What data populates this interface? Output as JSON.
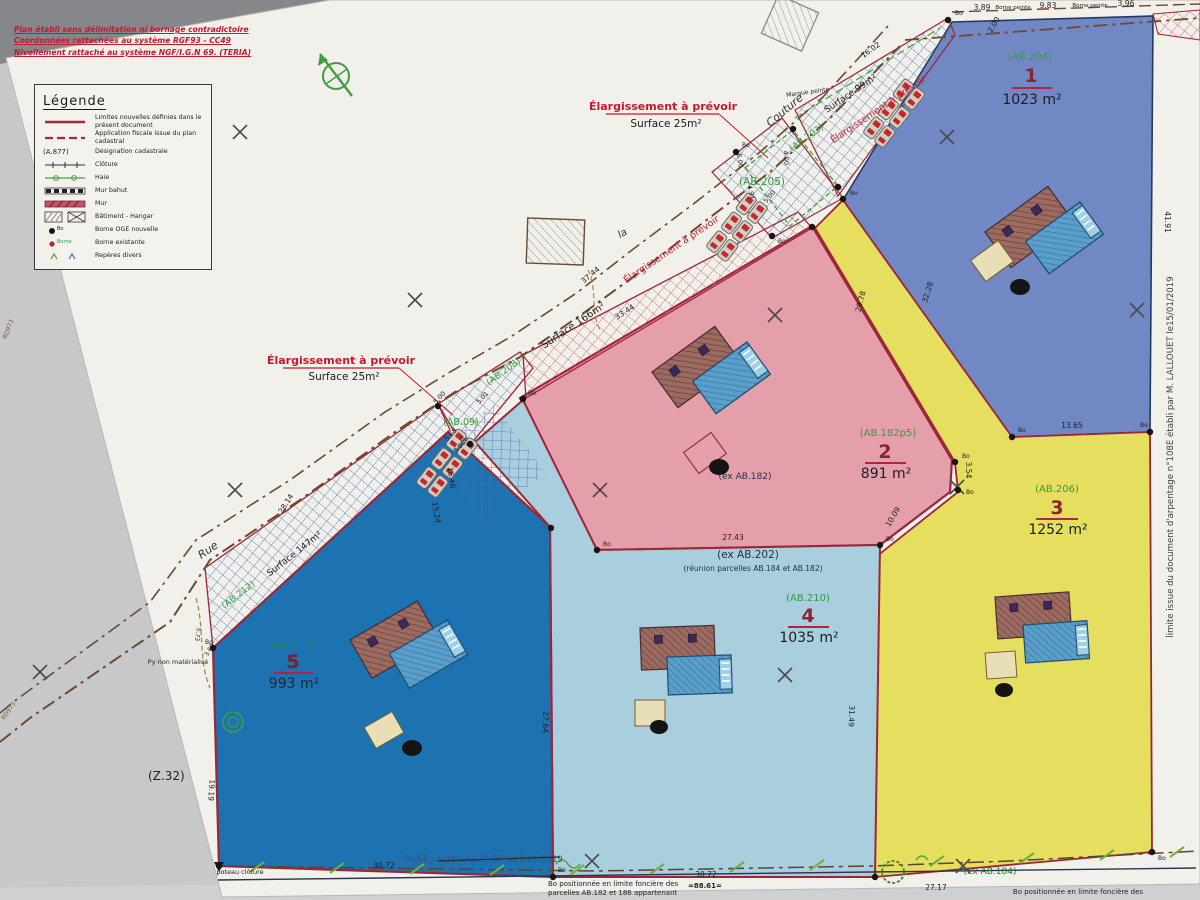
{
  "header_notes": [
    "Plan établi sans délimitation ni bornage contradictoire",
    "Coordonnées rattachées au système RGF93 - CC49",
    "Nivellement rattaché au système NGF/I.G.N 69. (TERIA)"
  ],
  "legend": {
    "title": "Légende",
    "items": [
      {
        "key": "",
        "label": "Limites nouvelles définies dans le présent document"
      },
      {
        "key": "",
        "label": "Application fiscale issue du plan cadastral"
      },
      {
        "key": "(A.877)",
        "label": "Désignation cadastrale"
      },
      {
        "key": "",
        "label": "Clôture"
      },
      {
        "key": "",
        "label": "Haie"
      },
      {
        "key": "",
        "label": "Mur bahut"
      },
      {
        "key": "",
        "label": "Mur"
      },
      {
        "key": "",
        "label": "Bâtiment - Hangar"
      },
      {
        "key": "Bo",
        "label": "Borne OGE nouvelle"
      },
      {
        "key": "Borne",
        "label": "Borne existante"
      },
      {
        "key": "",
        "label": "Repères divers"
      }
    ]
  },
  "parcels": [
    {
      "ref": "(AB.204)",
      "num": "1",
      "area": "1023 m²"
    },
    {
      "ref": "(AB.182p5)",
      "num": "2",
      "area": "891 m²",
      "ex": "(ex AB.182)"
    },
    {
      "ref": "(AB.206)",
      "num": "3",
      "area": "1252 m²"
    },
    {
      "ref": "(AB.210)",
      "num": "4",
      "area": "1035 m²",
      "ex": "(ex AB.202)",
      "ex_detail": "(réunion parcelles AB.184 et AB.182)"
    },
    {
      "ref": "(AB.211)",
      "num": "5",
      "area": "993 m²"
    }
  ],
  "labels": {
    "elargissement": "Élargissement à prévoir",
    "surface25": "Surface 25m²",
    "surface166": "Surface 166m²",
    "surface99": "Surface 99m²",
    "surface147": "Surface 147m²",
    "ab205": "(AB.205)",
    "ab208": "(AB.208)",
    "ab203": "(AB.203)",
    "ab09": "(AB.09)",
    "ab212": "(AB.212)",
    "ex_ab184": "(ex AB.184)",
    "z32": "(Z.32)",
    "rue": "Rue",
    "la": "la",
    "couture": "Couture",
    "marque_peinte": "Marque peinte",
    "borne_peinte": "Borne peinte",
    "py_non_materialise": "Py non matérialisé",
    "poteau_cloture": "poteau clôture",
    "bo": "Bo",
    "rd": "RD973"
  },
  "margin_notes": {
    "right_vertical": "limite issue du document d'arpentage n°108E établi par M. LALLOUET le15/01/2019",
    "bottom_struck": "établi par M. LALLOUET le15/01/2019",
    "bottom_bo_left_1": "Bo positionnée en limite foncière des",
    "bottom_bo_left_2": "parcelles AB.182 et 186 appartenant",
    "bottom_alt": "=88.61=",
    "bottom_bo_right": "Bo positionnée en limite foncière des"
  },
  "dims": [
    "3.89",
    "9.83",
    "3.96",
    "16.02",
    "2.00",
    "41.91",
    "13.65",
    "32.28",
    "29.78",
    "3.54",
    "10.09",
    "27.43",
    "33.44",
    "37.44",
    "28.14",
    "16.46",
    "15.24",
    "5.01",
    "5.00",
    "5.08",
    "3.08",
    "6.00",
    "4.91",
    "5.00",
    "19.19",
    "5.73",
    "3.60",
    "31.49",
    "27.64",
    "30.72",
    "30.72",
    "27.17",
    "4.00"
  ]
}
